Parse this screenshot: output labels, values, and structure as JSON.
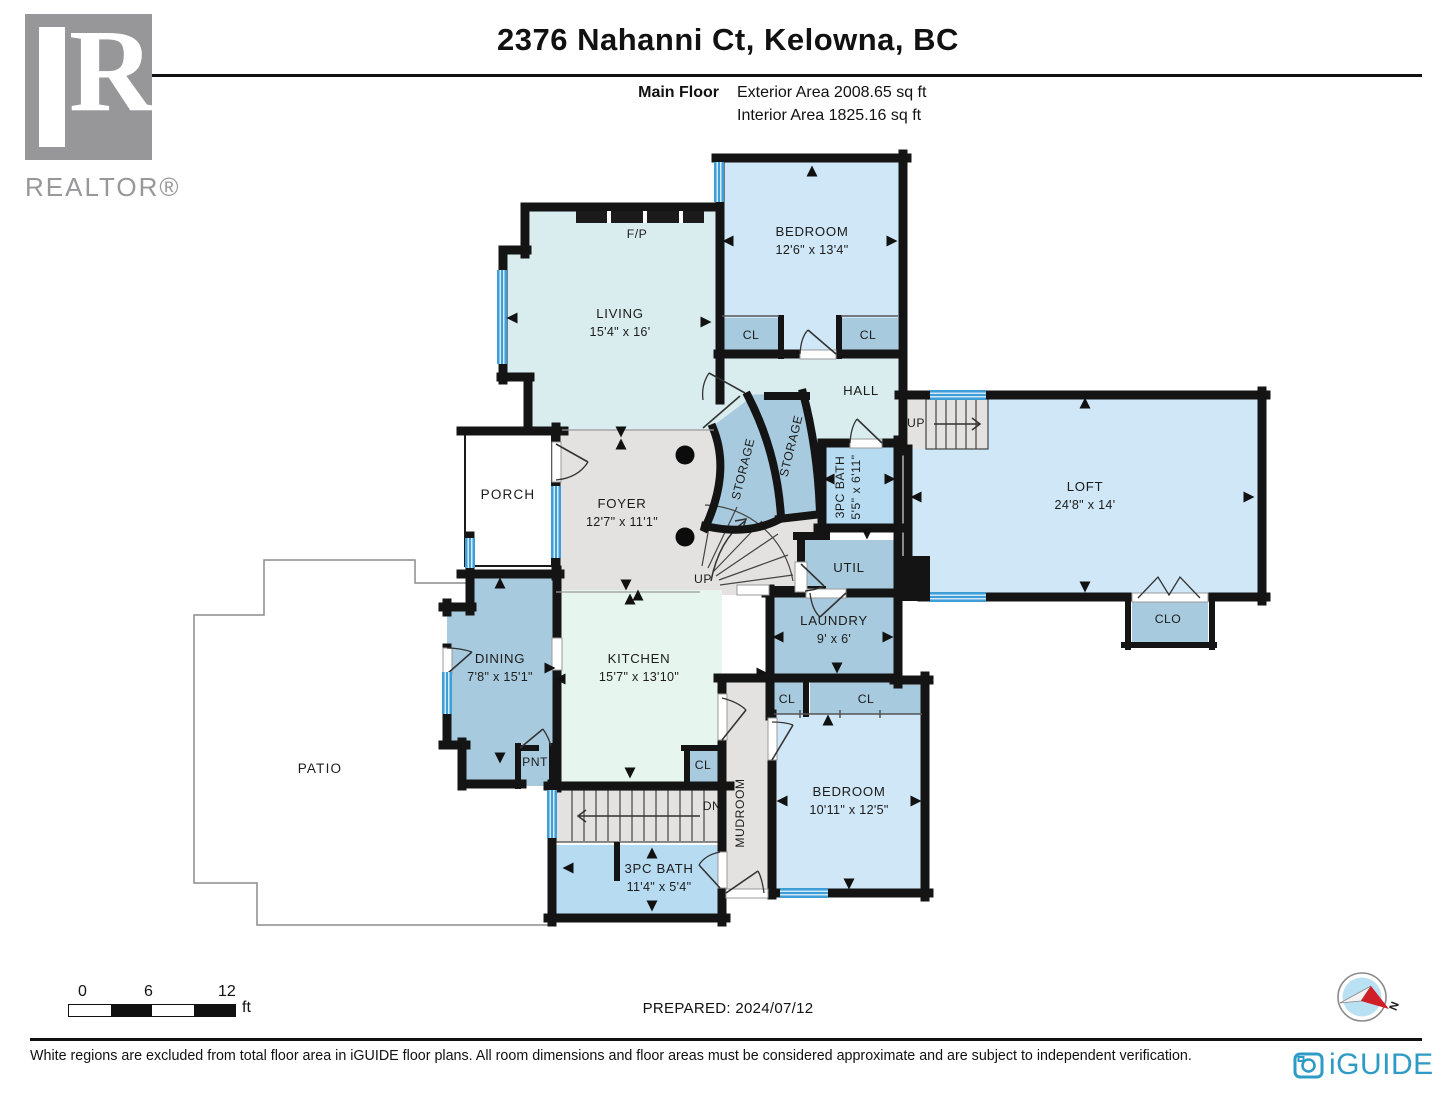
{
  "header": {
    "title": "2376 Nahanni Ct, Kelowna, BC",
    "floor_label": "Main Floor",
    "exterior_area": "Exterior Area 2008.65 sq ft",
    "interior_area": "Interior Area 1825.16 sq ft"
  },
  "branding": {
    "realtor": "REALTOR®",
    "realtor_r": "R",
    "iguide": "iGUIDE"
  },
  "rooms": {
    "living": {
      "name": "LIVING",
      "dims": "15'4\" x 16'"
    },
    "bedroom_top": {
      "name": "BEDROOM",
      "dims": "12'6\" x 13'4\""
    },
    "bedroom_bottom": {
      "name": "BEDROOM",
      "dims": "10'11\" x 12'5\""
    },
    "loft": {
      "name": "LOFT",
      "dims": "24'8\" x 14'"
    },
    "foyer": {
      "name": "FOYER",
      "dims": "12'7\" x 11'1\""
    },
    "dining": {
      "name": "DINING",
      "dims": "7'8\" x 15'1\""
    },
    "kitchen": {
      "name": "KITCHEN",
      "dims": "15'7\" x 13'10\""
    },
    "laundry": {
      "name": "LAUNDRY",
      "dims": "9' x 6'"
    },
    "bath_upper": {
      "name": "3PC BATH",
      "dims": "5'5\" x 6'11\""
    },
    "bath_lower": {
      "name": "3PC BATH",
      "dims": "11'4\" x 5'4\""
    },
    "hall": {
      "name": "HALL"
    },
    "porch": {
      "name": "PORCH"
    },
    "patio": {
      "name": "PATIO"
    },
    "mudroom": {
      "name": "MUDROOM"
    },
    "util": {
      "name": "UTIL"
    },
    "pantry": {
      "name": "PNT"
    },
    "storage_a": {
      "name": "STORAGE"
    },
    "storage_b": {
      "name": "STORAGE"
    },
    "closet_bed_top_left": {
      "name": "CL"
    },
    "closet_bed_top_right": {
      "name": "CL"
    },
    "closet_hall_small": {
      "name": "CL"
    },
    "closet_hall_wide": {
      "name": "CL"
    },
    "closet_kitchen": {
      "name": "CL"
    },
    "closet_loft": {
      "name": "CLO"
    },
    "fireplace": {
      "name": "F/P"
    }
  },
  "stairs": {
    "up_loft": "UP",
    "up_foyer": "UP",
    "down": "DN"
  },
  "scale_bar": {
    "t0": "0",
    "t6": "6",
    "t12": "12",
    "unit": "ft"
  },
  "compass": {
    "north": "N"
  },
  "footer": {
    "prepared": "PREPARED: 2024/07/12",
    "disclaimer": "White regions are excluded from total floor area in iGUIDE floor plans. All room dimensions and floor areas must be considered approximate and are subject to independent verification."
  },
  "colors": {
    "room_cyan": "#d9edef",
    "room_blue": "#cfe7f6",
    "room_green": "#e6f5ee",
    "room_mid_blue": "#a7cade",
    "bath_blue": "#b7dcf2",
    "floor_gray": "#e3e2e0",
    "window_blue": "#3e9ed8",
    "wall": "#141414",
    "iguide_blue": "#2e9bc6",
    "compass_red": "#cf2027"
  }
}
